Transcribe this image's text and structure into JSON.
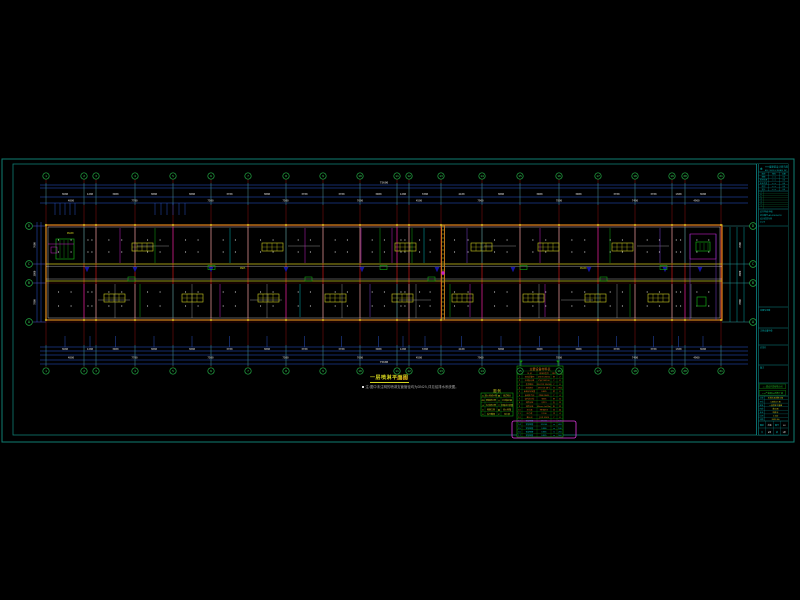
{
  "annotations": {
    "title": "一层喷淋平面图",
    "scale": "1:100",
    "note": "注:图中未注明的喷淋支管管径均为DN25,详见给排水系统图。"
  },
  "colors": {
    "frame": "#0f7e72",
    "block": "#0d9b9b",
    "dim": "#2b59d8",
    "dimtext": "#e0e0e0",
    "grid": "#7a0d0d",
    "gridB": "#b01515",
    "bubble": "#22aa44",
    "bubbleT": "#3ed45e",
    "wall": "#cf7d1a",
    "white": "#e6e6e6",
    "corr": "#c9c91c",
    "navy": "#1515a0",
    "cyan": "#00b5b5",
    "magenta": "#c41ec4",
    "green": "#13a913",
    "purple": "#7d3fd0",
    "gray": "#c2c2c2",
    "yellow": "#cfcf20",
    "orange": "#d07818",
    "tgreen": "#0fa00f",
    "hl": "#e23ae2",
    "note": "#b8b8b8"
  },
  "plan": {
    "grid_x": [
      46,
      84,
      96,
      135,
      173,
      211,
      248,
      286,
      323,
      360,
      397,
      409,
      441,
      482,
      520,
      559,
      598,
      635,
      672,
      685,
      721
    ],
    "grid_labels": [
      "1",
      "2",
      "3",
      "4",
      "5",
      "6",
      "7",
      "8",
      "9",
      "10",
      "11",
      "12",
      "13",
      "14",
      "15",
      "16",
      "17",
      "18",
      "19",
      "20",
      "21"
    ],
    "row_labels": [
      "D",
      "C",
      "B",
      "A"
    ],
    "row_ys": [
      226,
      264,
      283,
      322
    ],
    "top_dim_y": [
      185,
      188,
      197,
      203
    ],
    "bottom_dim_y": [
      347,
      351,
      355,
      360,
      364
    ],
    "dims_row1": [
      "3600",
      "1200",
      "3900",
      "3800",
      "3800",
      "3700",
      "3800",
      "3700",
      "3700",
      "3900",
      "1200",
      "3300",
      "4100",
      "3800",
      "3900",
      "3900",
      "3700",
      "3700",
      "1300",
      "3600"
    ],
    "dims_row2": [
      "4800",
      "7700",
      "7500",
      "7500",
      "7600",
      "4500",
      "7900",
      "7800",
      "7400",
      "4900"
    ],
    "dims_total": "75600",
    "side_dims": [
      "7600",
      "3800",
      "7800"
    ],
    "side_total": "19200",
    "riser_x": [
      87,
      135,
      211,
      286,
      362,
      437,
      513,
      589,
      665,
      700
    ],
    "hydrant_x": [
      128,
      208,
      305,
      380,
      428,
      520,
      600,
      660
    ],
    "fixtures_top": [
      132,
      262,
      395,
      471,
      538,
      612
    ],
    "fixtures_bottom": [
      104,
      182,
      258,
      325,
      392,
      452,
      523,
      585,
      648
    ],
    "pipes": [
      {
        "x": 120,
        "b": "T",
        "c": "magenta"
      },
      {
        "x": 155,
        "b": "T",
        "c": "green"
      },
      {
        "x": 230,
        "b": "T",
        "c": "cyan"
      },
      {
        "x": 305,
        "b": "T",
        "c": "magenta"
      },
      {
        "x": 361,
        "b": "T",
        "c": "magenta"
      },
      {
        "x": 380,
        "b": "T",
        "c": "green"
      },
      {
        "x": 392,
        "b": "T",
        "c": "magenta"
      },
      {
        "x": 412,
        "b": "T",
        "c": "green"
      },
      {
        "x": 424,
        "b": "T",
        "c": "cyan"
      },
      {
        "x": 467,
        "b": "T",
        "c": "purple"
      },
      {
        "x": 540,
        "b": "T",
        "c": "magenta"
      },
      {
        "x": 610,
        "b": "T",
        "c": "green"
      },
      {
        "x": 660,
        "b": "T",
        "c": "purple"
      },
      {
        "x": 140,
        "b": "B",
        "c": "green"
      },
      {
        "x": 220,
        "b": "B",
        "c": "magenta"
      },
      {
        "x": 300,
        "b": "B",
        "c": "cyan"
      },
      {
        "x": 370,
        "b": "B",
        "c": "purple"
      },
      {
        "x": 450,
        "b": "B",
        "c": "green"
      },
      {
        "x": 470,
        "b": "B",
        "c": "magenta"
      },
      {
        "x": 545,
        "b": "B",
        "c": "magenta"
      },
      {
        "x": 630,
        "b": "B",
        "c": "green"
      }
    ]
  },
  "legend_table": {
    "title": "图    例",
    "rows": [
      [
        "-X-",
        "消火栓给水管",
        "●",
        "闭式喷头"
      ],
      [
        "-ZP-",
        "喷淋给水管",
        "◎",
        "水流指示器"
      ],
      [
        "-J-",
        "生活给水管",
        "▽",
        "末端试水装置"
      ],
      [
        "⊙",
        "喷淋立管",
        "▣",
        "消火栓箱"
      ],
      [
        "✕",
        "信号蝶阀",
        "P",
        "压力表"
      ]
    ]
  },
  "material_table": {
    "title": "主要设备材料表",
    "headers": [
      "编号",
      "名  称",
      "规格及型号",
      "单位",
      "数量"
    ],
    "cyan_from": 12,
    "rows": [
      [
        "1",
        "湿式报警阀",
        "ZSFZ DN150",
        "套",
        "2"
      ],
      [
        "2",
        "水流指示器",
        "ZSJZ DN100",
        "个",
        "8"
      ],
      [
        "3",
        "信号蝶阀",
        "XD371X DN100",
        "个",
        "8"
      ],
      [
        "4",
        "闭式喷头",
        "ZSTX15 68℃",
        "只",
        "356"
      ],
      [
        "5",
        "末端试水装置",
        "DN25",
        "套",
        "8"
      ],
      [
        "6",
        "自动排气阀",
        "ZP88 DN25",
        "个",
        "4"
      ],
      [
        "7",
        "室内消火栓",
        "SN65",
        "套",
        "22"
      ],
      [
        "8",
        "消防水枪",
        "QZ19",
        "支",
        "22"
      ],
      [
        "9",
        "消防水带",
        "65mm L=25m",
        "条",
        "22"
      ],
      [
        "10",
        "灭火器",
        "MF/ABC5",
        "具",
        "44"
      ],
      [
        "11",
        "压力表",
        "Y-100",
        "块",
        "4"
      ],
      [
        "12",
        "截止阀",
        "J11X DN25",
        "个",
        "8"
      ],
      [
        "13",
        "镀锌钢管",
        "DN150",
        "m",
        "120"
      ],
      [
        "14",
        "镀锌钢管",
        "DN100",
        "m",
        "420"
      ],
      [
        "15",
        "镀锌钢管",
        "DN80",
        "m",
        "180"
      ],
      [
        "16",
        "镀锌钢管",
        "DN65",
        "m",
        "260"
      ],
      [
        "17",
        "镀锌钢管",
        "DN25",
        "m",
        "560"
      ]
    ]
  },
  "title_block": {
    "company": "××省建筑设计研究院",
    "company_en": "ARCH. DESIGN & RESEARCH INST.",
    "personnel_header": [
      "审定",
      "签名",
      "日期"
    ],
    "personnel_rows": [
      [
        "审核",
        "×××",
        "06"
      ],
      [
        "项目负责",
        "×××",
        "06"
      ],
      [
        "专业负责",
        "×××",
        "06"
      ],
      [
        "校对",
        "×××",
        "06"
      ],
      [
        "设计",
        "×××",
        "06"
      ]
    ],
    "revisions": [
      "7",
      "6",
      "5",
      "4",
      "3",
      "2",
      "1"
    ],
    "cert": [
      "证书等级:甲级",
      "证书编号:A142005678",
      "设计资质专用",
      "2023"
    ],
    "stamps": [
      "出图专用章",
      "注册设备师章",
      "会签栏",
      "备注"
    ],
    "client": "××建设开发有限公司",
    "project": "××产业园1#综合厂房",
    "info_rows": [
      [
        "工程",
        "给排水及消防工程"
      ],
      [
        "子项",
        "1#综合厂房"
      ],
      [
        "图名",
        "一层喷淋平面图"
      ],
      [
        "阶段",
        "施工图"
      ],
      [
        "专业",
        "给排水"
      ],
      [
        "比例",
        "1:100"
      ],
      [
        "日期",
        "2023.06"
      ]
    ],
    "bottom_rows": [
      [
        "图别",
        "水施",
        "图号",
        "03"
      ],
      [
        "共",
        "8张",
        "第",
        "3张"
      ]
    ]
  }
}
